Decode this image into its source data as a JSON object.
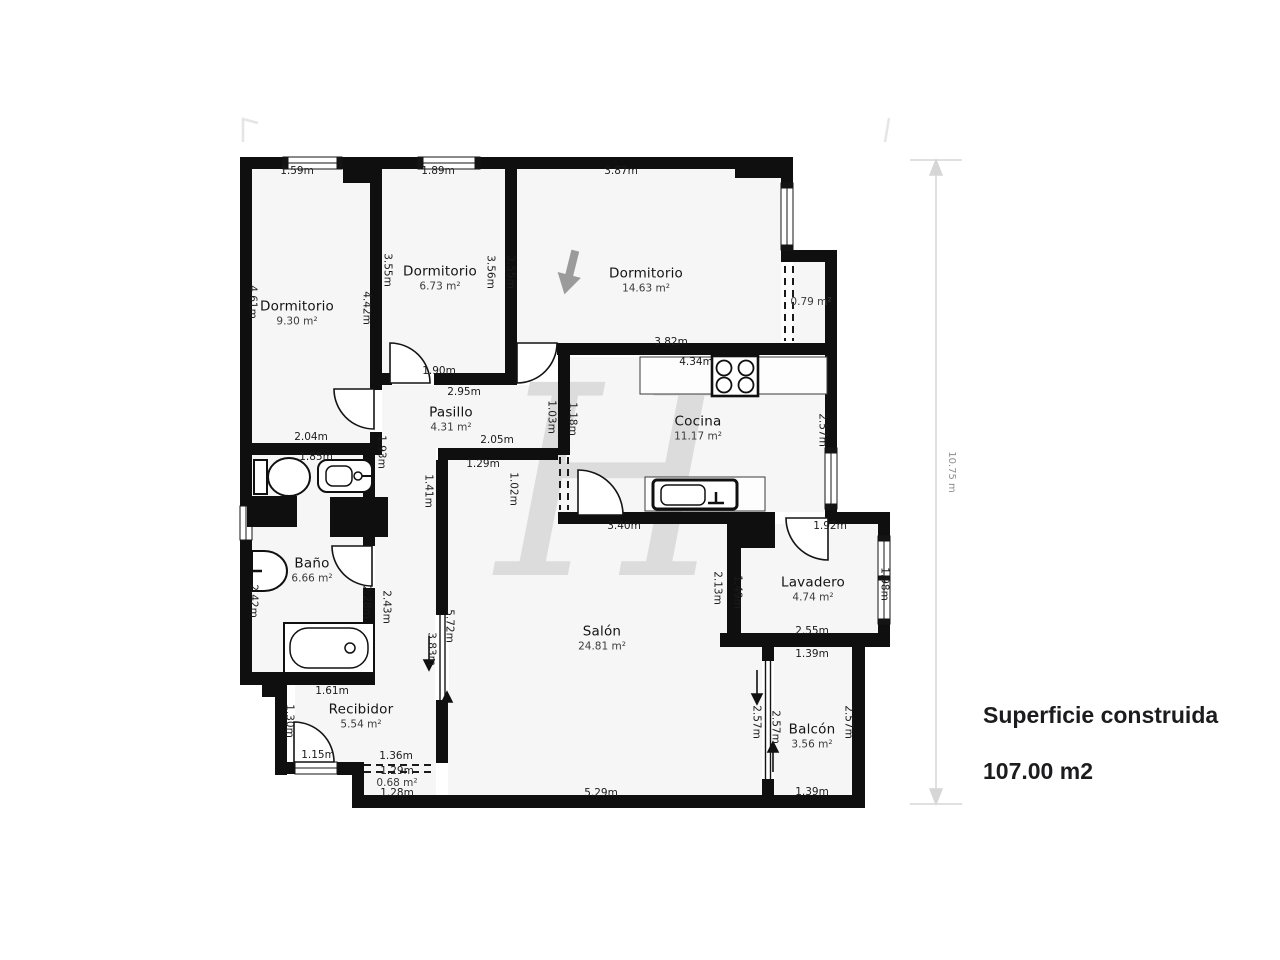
{
  "watermark": "H",
  "summary": {
    "title": "Superficie construida",
    "value": "107.00 m2"
  },
  "scale": {
    "label": "10.75 m"
  },
  "rooms": {
    "dorm1": {
      "name": "Dormitorio",
      "area": "9.30 m²"
    },
    "dorm2": {
      "name": "Dormitorio",
      "area": "6.73 m²"
    },
    "dorm3": {
      "name": "Dormitorio",
      "area": "14.63 m²"
    },
    "cocina": {
      "name": "Cocina",
      "area": "11.17 m²"
    },
    "pasillo": {
      "name": "Pasillo",
      "area": "4.31 m²"
    },
    "bano": {
      "name": "Baño",
      "area": "6.66 m²"
    },
    "salon": {
      "name": "Salón",
      "area": "24.81 m²"
    },
    "recibidor": {
      "name": "Recibidor",
      "area": "5.54 m²"
    },
    "lavadero": {
      "name": "Lavadero",
      "area": "4.74 m²"
    },
    "balcon": {
      "name": "Balcón",
      "area": "3.56 m²"
    },
    "closet1": {
      "area": "0.79 m²"
    },
    "closet2": {
      "area": "0.68 m²"
    }
  },
  "dims": {
    "d01": "1.59m",
    "d02": "1.89m",
    "d03": "3.87m",
    "d04": "4.61m",
    "d05": "4.42m",
    "d06": "3.55m",
    "d07": "3.56m",
    "d08": "3.55m",
    "d09": "1.90m",
    "d10": "2.95m",
    "d11": "2.05m",
    "d12": "1.29m",
    "d13": "1.93m",
    "d14": "1.03m",
    "d15": "1.18m",
    "d16": "1.41m",
    "d17": "1.02m",
    "d18": "3.82m",
    "d19": "4.34m",
    "d21": "2.57m",
    "d22": "2.36m",
    "d23": "3.40m",
    "d24": "2.04m",
    "d25": "1.85m",
    "d26": "2.42m",
    "d27": "2.28m",
    "d28": "2.43m",
    "d29": "2.04m",
    "d30": "1.61m",
    "d31": "1.30m",
    "d32": "1.15m",
    "d33": "5.72m",
    "d34": "3.83m",
    "d35": "1.36m",
    "d36": "1.29m",
    "d37": "1.28m",
    "d38": "5.29m",
    "d39": "1.92m",
    "d40": "2.13m",
    "d41": "1.49m",
    "d42": "1.98m",
    "d43": "2.55m",
    "d44": "1.39m",
    "d45": "2.57m",
    "d46": "2.57m",
    "d47": "2.57m",
    "d48": "1.39m"
  }
}
